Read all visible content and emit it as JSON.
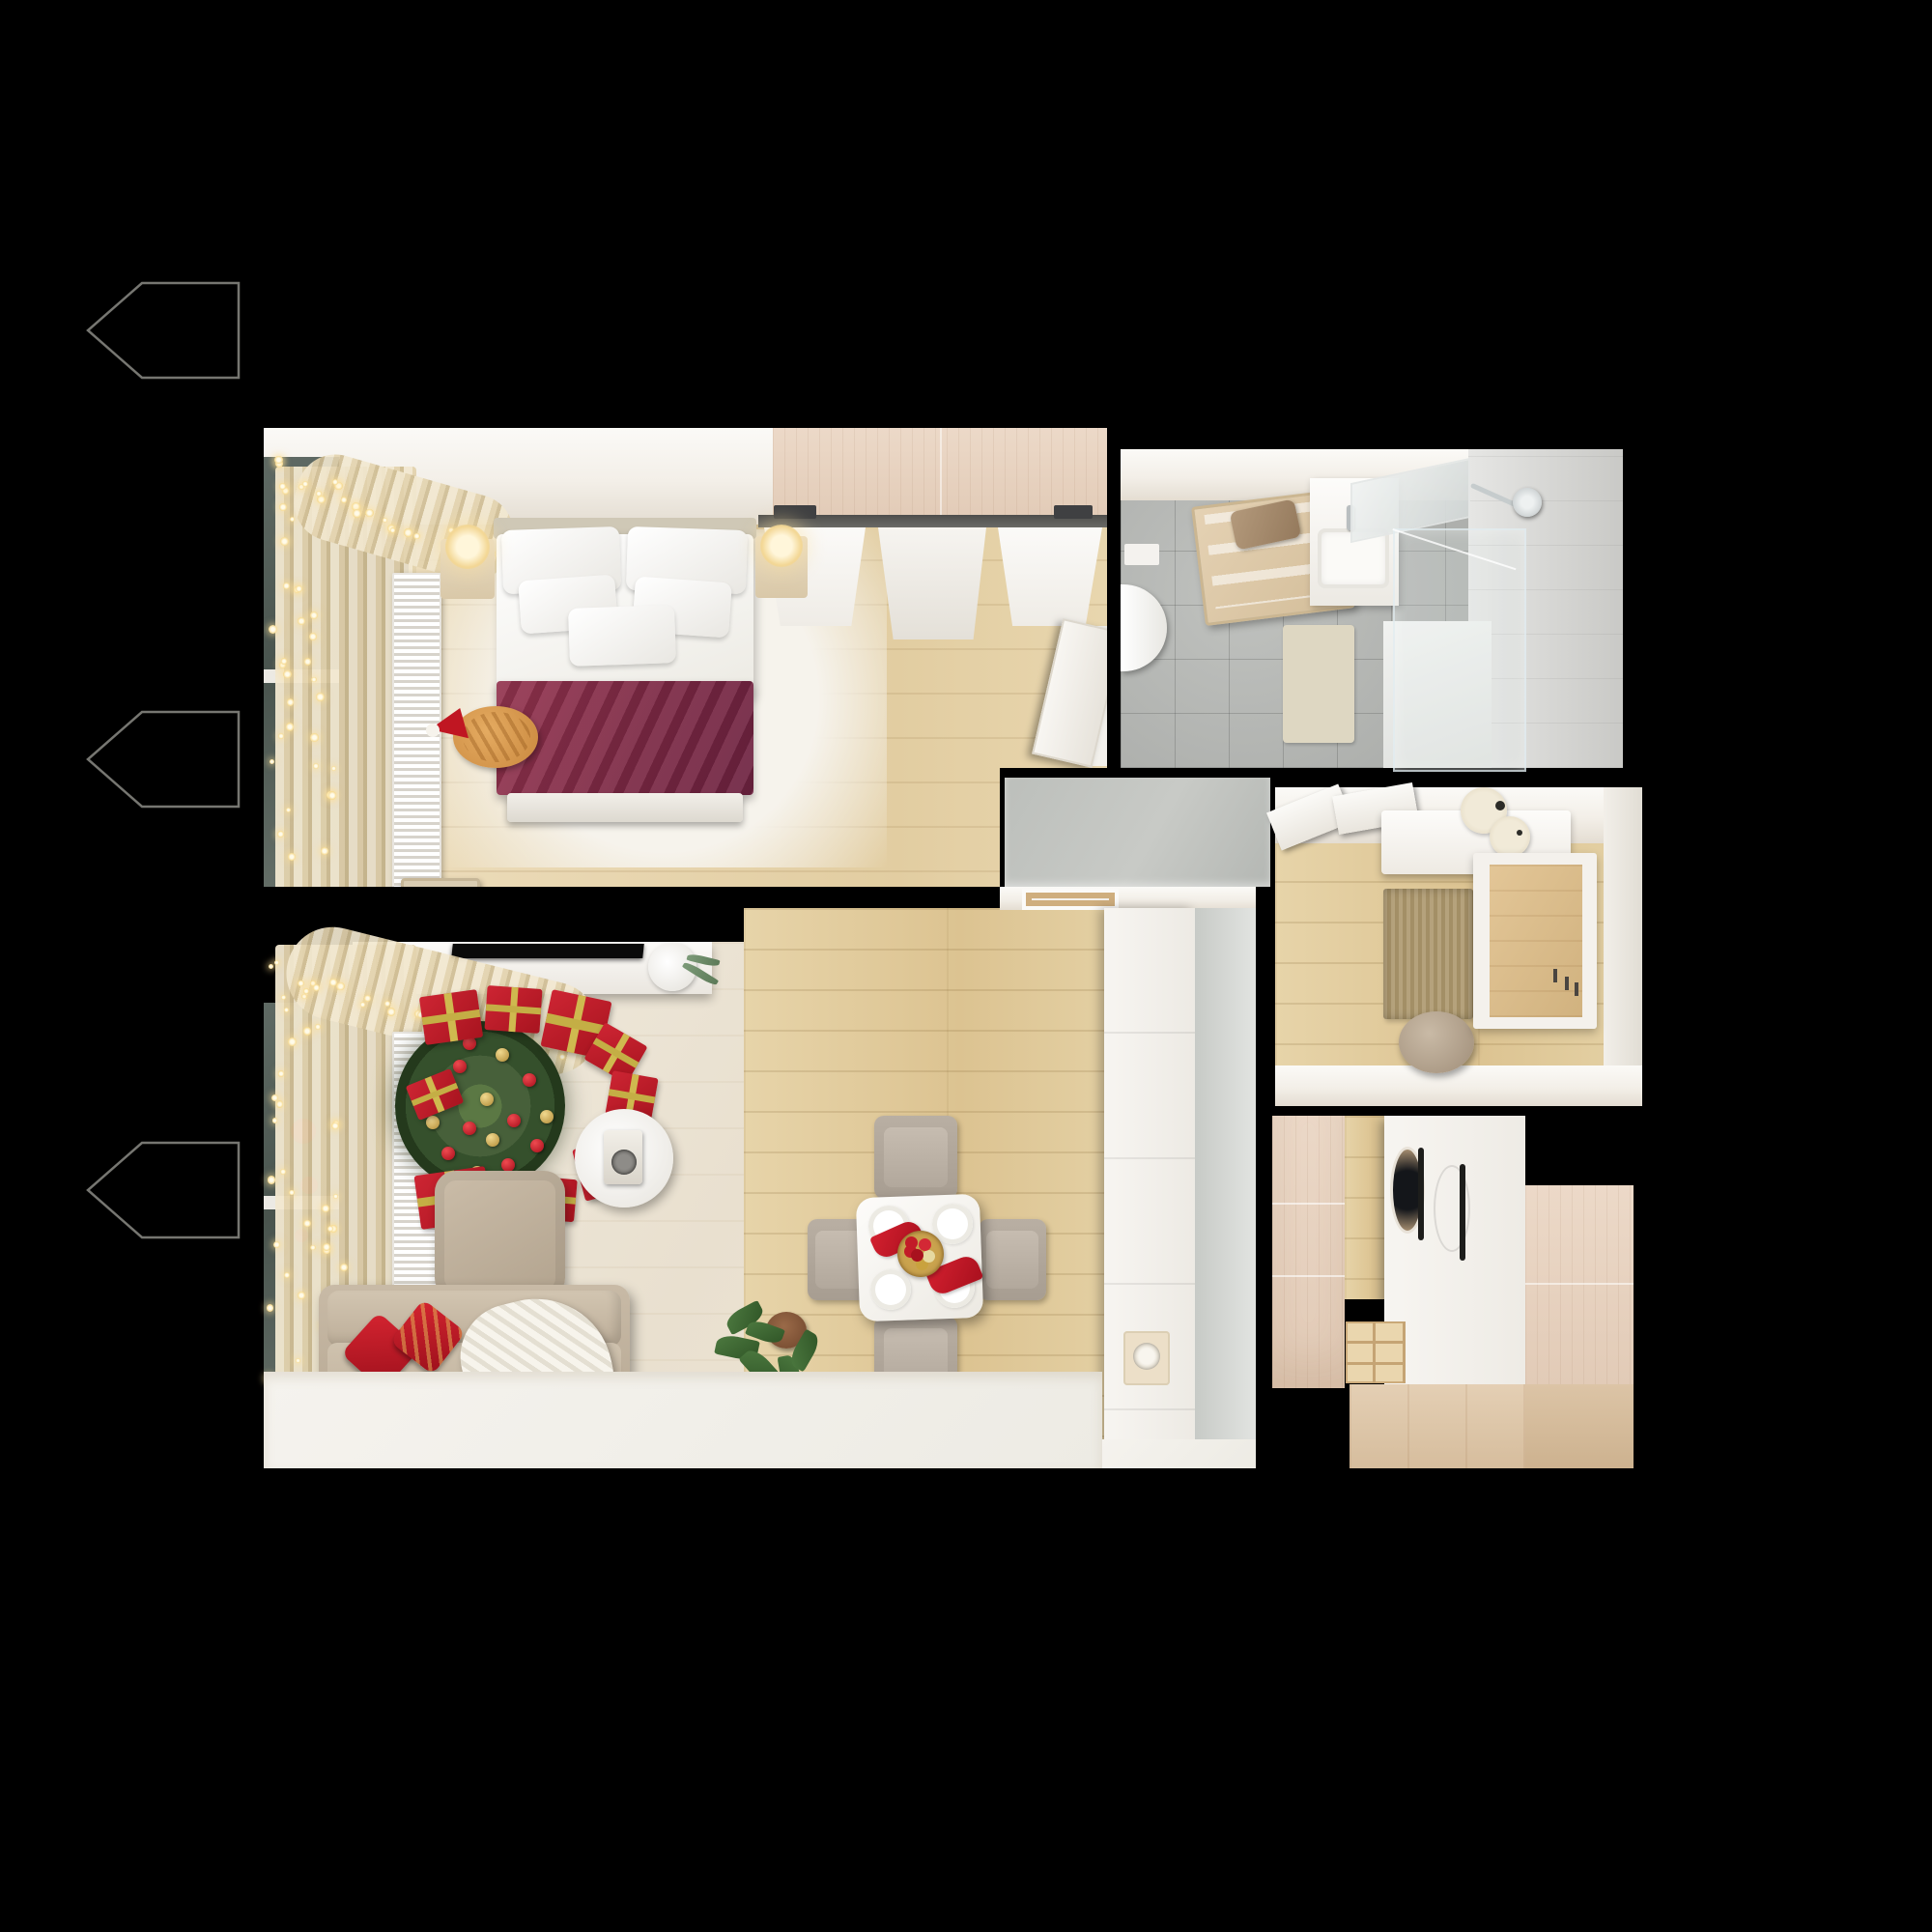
{
  "scene": {
    "type": "apartment-floorplan-3d-render",
    "view": "top-down",
    "theme": "one-bedroom apartment interior decorated for Christmas",
    "background_color": "#000000",
    "rooms": [
      {
        "name": "Bedroom",
        "items": [
          "double bed with white bedding",
          "burgundy blanket",
          "ginger cat with santa hat",
          "two nightstand lamps",
          "sliding-door wardrobe",
          "window with string lights and cream curtains",
          "radiator",
          "dresser with TV",
          "storage box",
          "open white door"
        ]
      },
      {
        "name": "Bathroom",
        "items": [
          "toilet",
          "wooden ladder shelf with towels",
          "vanity with sink and mirror",
          "glass shower with shower head",
          "beige bath mat",
          "gray tile floor"
        ]
      },
      {
        "name": "Corridor",
        "items": [
          "gray floor"
        ]
      },
      {
        "name": "Entry Hall",
        "items": [
          "white console with candles",
          "open white doors",
          "jute rug",
          "round pouf",
          "wardrobe niche with wood back",
          "oak floor"
        ]
      },
      {
        "name": "Living Room with Kitchen",
        "items": [
          "TV console with TV and eucalyptus vase",
          "Christmas tree with red and gold ornaments",
          "red gift boxes",
          "round side table with instant camera",
          "beige armchair",
          "beige sofa with red pillows and knit throw",
          "potted plant",
          "white dining table set for four with red napkins and ornament bowl",
          "four dining chairs",
          "white kitchen counter with sink",
          "tall gray cabinets",
          "window with string lights",
          "radiator",
          "white rug"
        ]
      },
      {
        "name": "Laundry / Storage",
        "items": [
          "washer and dryer column behind white fronts",
          "light wood wardrobe panels",
          "cubby shelf",
          "oak floor",
          "beige base cabinets"
        ]
      }
    ],
    "palette": {
      "background": "#000000",
      "oak_floor": "#dcc391",
      "pale_floor": "#ece4d4",
      "tile_gray": "#aeb0ad",
      "wall_white": "#f6f3ef",
      "blanket_burgundy": "#8c2e4d",
      "gift_red": "#c0202e",
      "ribbon_gold": "#cfb94f",
      "tree_green": "#41572f",
      "sofa_beige": "#c3b6a4",
      "curtain_cream": "#e9dab4",
      "string_light": "#f6d98e",
      "cat_ginger": "#d id99a55"
    }
  }
}
